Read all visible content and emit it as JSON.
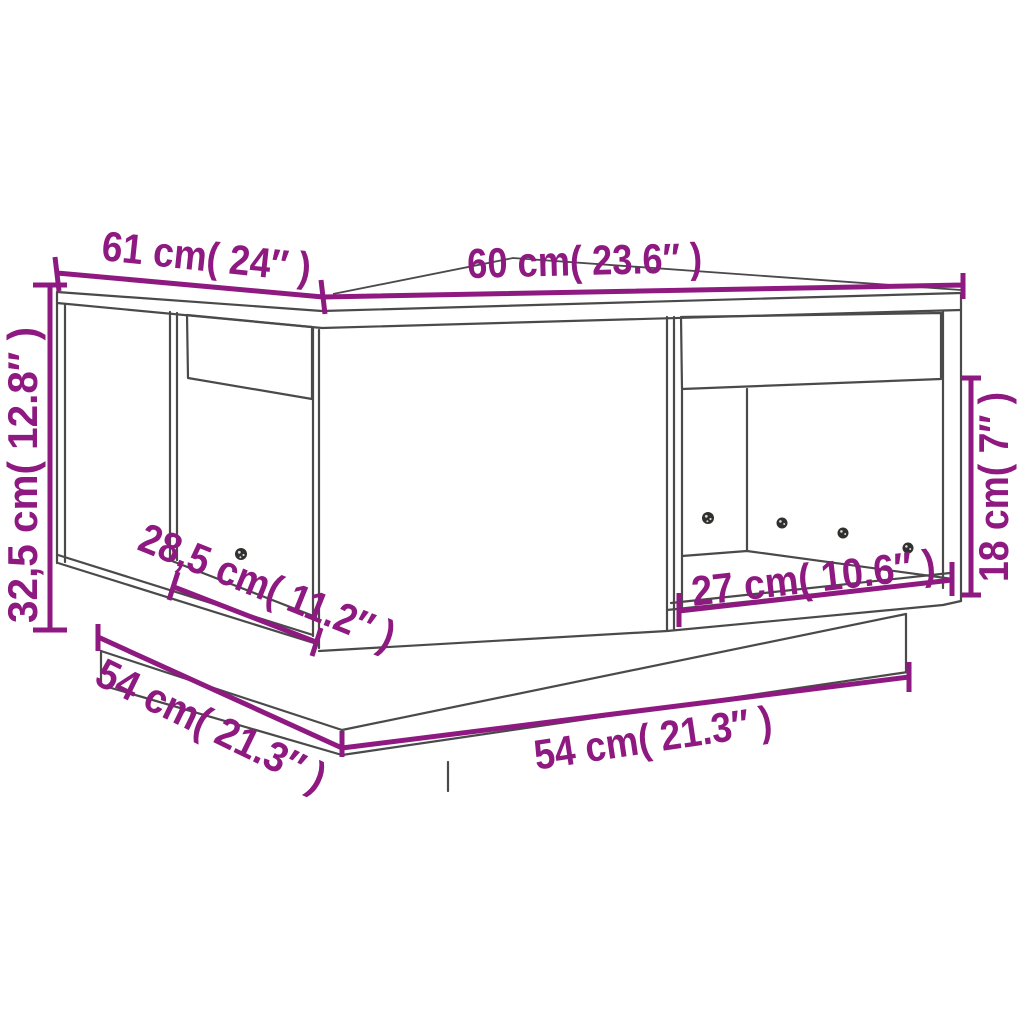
{
  "diagram": {
    "type": "furniture-dimension-diagram",
    "subject": "coffee table with two drawers, two open compartments and plinth base"
  },
  "colors": {
    "dimension": "#8E1980",
    "outline": "#4A4A4A",
    "background": "#FFFFFF"
  },
  "dimensions": {
    "depth_top": {
      "cm": "61",
      "in": "24",
      "label": "61 cm( 24″  )"
    },
    "width_top": {
      "cm": "60",
      "in": "23.6",
      "label": "60 cm( 23.6″  )"
    },
    "height": {
      "cm": "32,5",
      "in": "12.8",
      "label": "32,5 cm( 12.8″ )"
    },
    "left_opening_width": {
      "cm": "28,5",
      "in": "11.2",
      "label": "28,5 cm( 11.2″  )"
    },
    "base_depth": {
      "cm": "54",
      "in": "21.3",
      "label": "54 cm( 21.3″  )"
    },
    "base_width": {
      "cm": "54",
      "in": "21.3",
      "label": "54 cm( 21.3″  )"
    },
    "right_opening_width": {
      "cm": "27",
      "in": "10.6",
      "label": "27 cm( 10.6″  )"
    },
    "opening_height": {
      "cm": "18",
      "in": "7",
      "label": "18 cm( 7″ )"
    }
  }
}
